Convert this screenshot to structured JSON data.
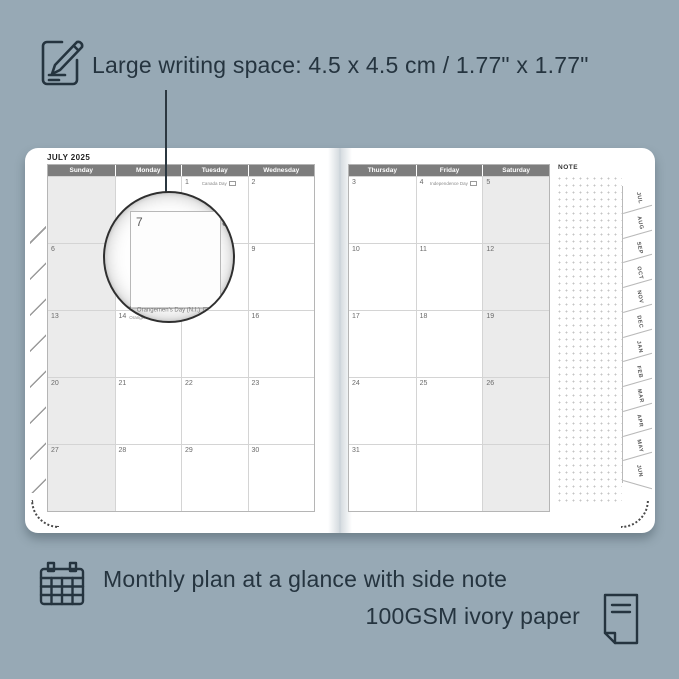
{
  "colors": {
    "background": "#97a9b5",
    "ink": "#25343f",
    "page": "#ffffff",
    "weekday_header_bg": "#7d7d7d",
    "weekend_shade": "#ebebeb",
    "grid_line": "#d4d4d4"
  },
  "features": {
    "top": {
      "icon": "pencil-note-icon",
      "text": "Large writing space: 4.5 x 4.5 cm / 1.77\" x 1.77\""
    },
    "bottom_line1": {
      "icon": "calendar-grid-icon",
      "text": "Monthly plan at a glance with side note"
    },
    "bottom_line2": {
      "icon": "paper-sheet-icon",
      "text": "100GSM ivory paper"
    }
  },
  "planner": {
    "month_title": "JULY 2025",
    "note_label": "NOTE",
    "left_page": {
      "headers": [
        "Sunday",
        "Monday",
        "Tuesday",
        "Wednesday"
      ],
      "rows": [
        [
          {
            "day": ""
          },
          {
            "day": ""
          },
          {
            "day": "1",
            "holiday": "Canada Day"
          },
          {
            "day": "2"
          }
        ],
        [
          {
            "day": "6"
          },
          {
            "day": "7"
          },
          {
            "day": "8"
          },
          {
            "day": "9"
          }
        ],
        [
          {
            "day": "13"
          },
          {
            "day": "14",
            "holiday": "Orangemen's Day (N.I.)"
          },
          {
            "day": "15"
          },
          {
            "day": "16"
          }
        ],
        [
          {
            "day": "20"
          },
          {
            "day": "21"
          },
          {
            "day": "22"
          },
          {
            "day": "23"
          }
        ],
        [
          {
            "day": "27"
          },
          {
            "day": "28"
          },
          {
            "day": "29"
          },
          {
            "day": "30"
          }
        ]
      ]
    },
    "right_page": {
      "headers": [
        "Thursday",
        "Friday",
        "Saturday"
      ],
      "rows": [
        [
          {
            "day": "3"
          },
          {
            "day": "4",
            "holiday": "Independence Day"
          },
          {
            "day": "5"
          }
        ],
        [
          {
            "day": "10"
          },
          {
            "day": "11"
          },
          {
            "day": "12"
          }
        ],
        [
          {
            "day": "17"
          },
          {
            "day": "18"
          },
          {
            "day": "19"
          }
        ],
        [
          {
            "day": "24"
          },
          {
            "day": "25"
          },
          {
            "day": "26"
          }
        ],
        [
          {
            "day": "31"
          },
          {
            "day": ""
          },
          {
            "day": ""
          }
        ]
      ]
    },
    "tabs": [
      "JUL",
      "AUG",
      "SEP",
      "OCT",
      "NOV",
      "DEC",
      "JAN",
      "FEB",
      "MAR",
      "APR",
      "MAY",
      "JUN"
    ],
    "magnifier": {
      "day_left": "7",
      "day_right": "8",
      "bottom_day": "4",
      "bottom_holiday": "Orangemen's Day (N.I.)"
    }
  }
}
